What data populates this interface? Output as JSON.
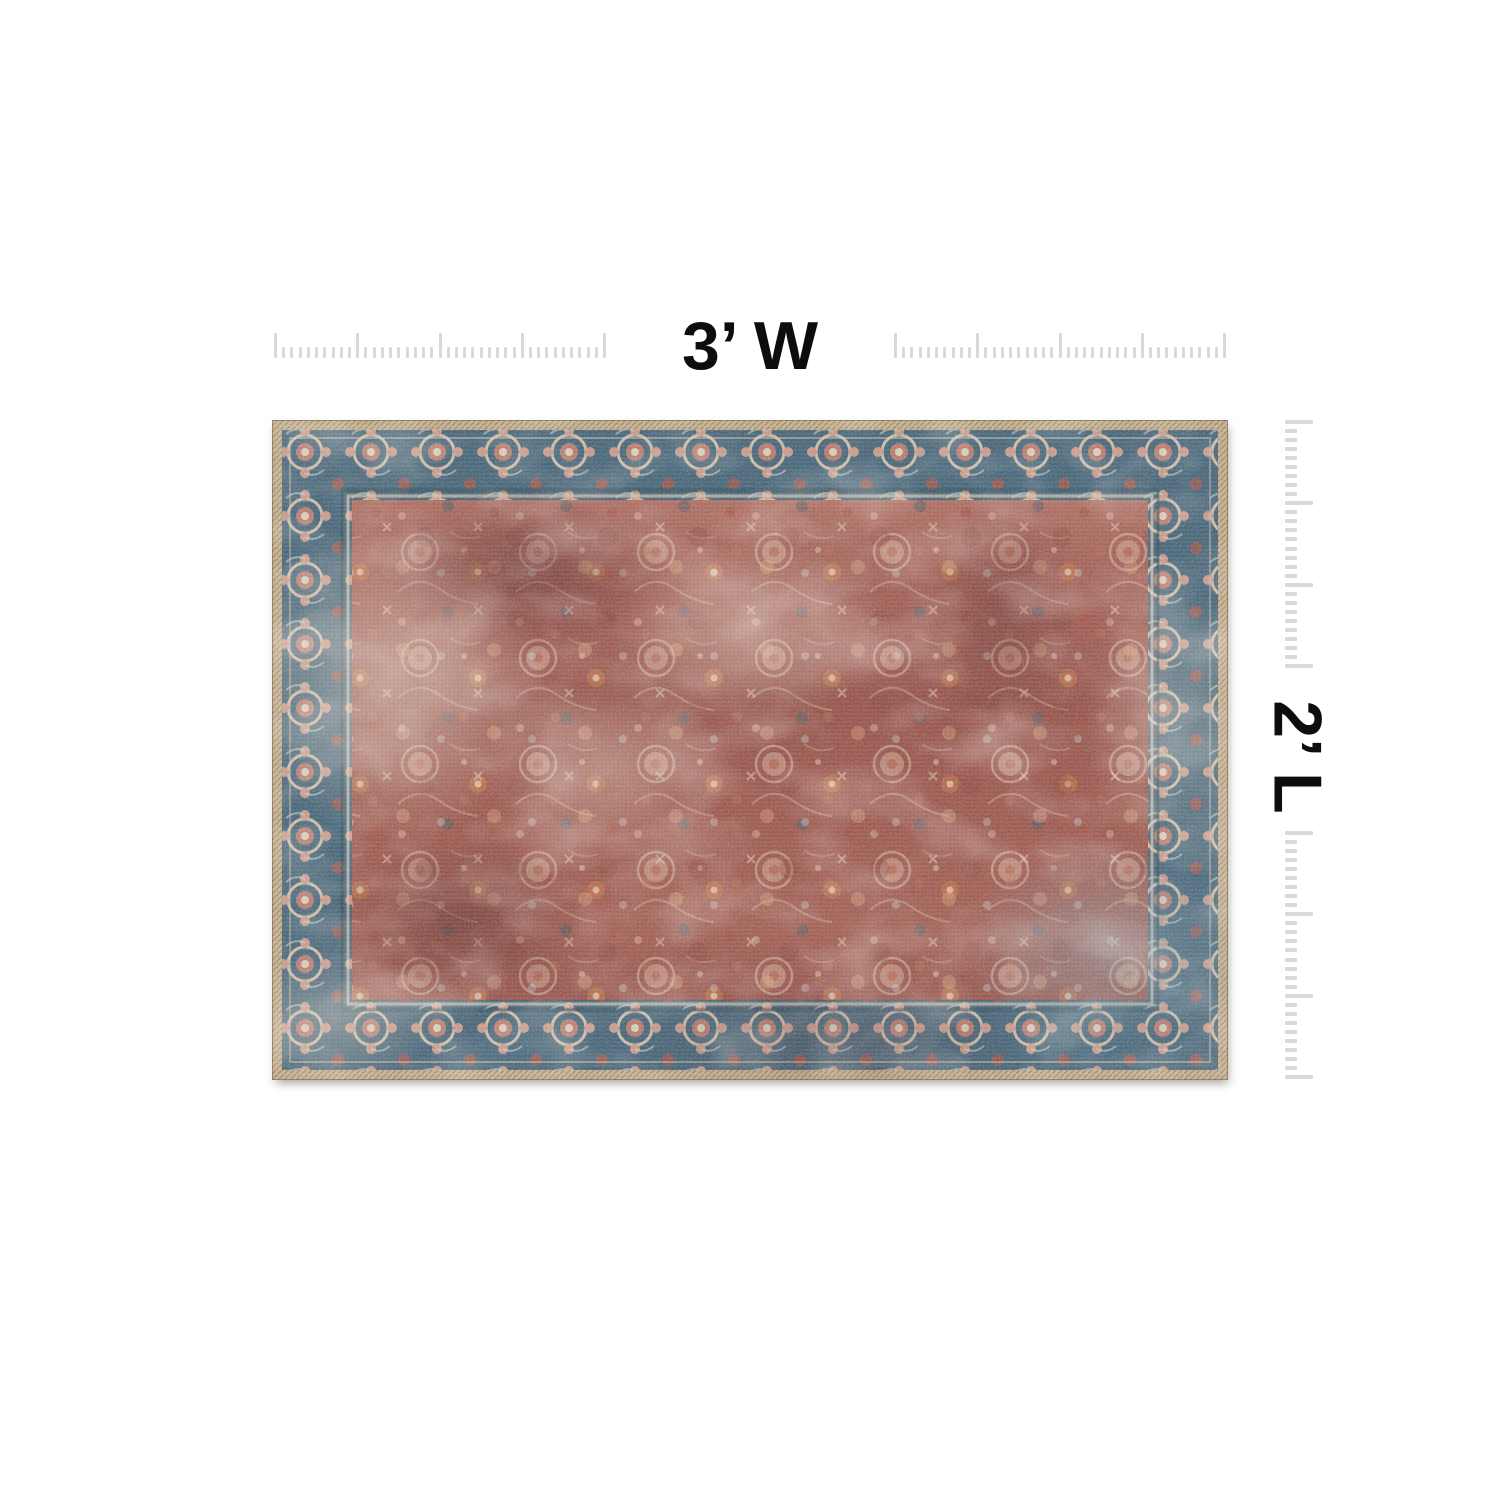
{
  "page": {
    "background_color": "#ffffff"
  },
  "annotations": {
    "width_label": "3’ W",
    "length_label": "2’ L"
  },
  "rulers": {
    "tick_color": "#d9d9d9",
    "horizontal": {
      "tick_count": 41,
      "major_every": 10
    },
    "vertical": {
      "tick_count": 28,
      "major_every": 9
    }
  },
  "rug": {
    "description": "vintage distressed oriental area rug, rust-red floral field with teal floral border and tan serged edge",
    "colors": {
      "edge_tan": "#c8b492",
      "border_teal": "#47687c",
      "border_flower_pink": "#c99081",
      "border_cream": "#ddcbb6",
      "field_rust": "#9d5a51",
      "field_dark": "#71413f",
      "accent_orange": "#c27a4b",
      "accent_cream": "#e3d0bf",
      "accent_navy": "#44596b"
    }
  }
}
